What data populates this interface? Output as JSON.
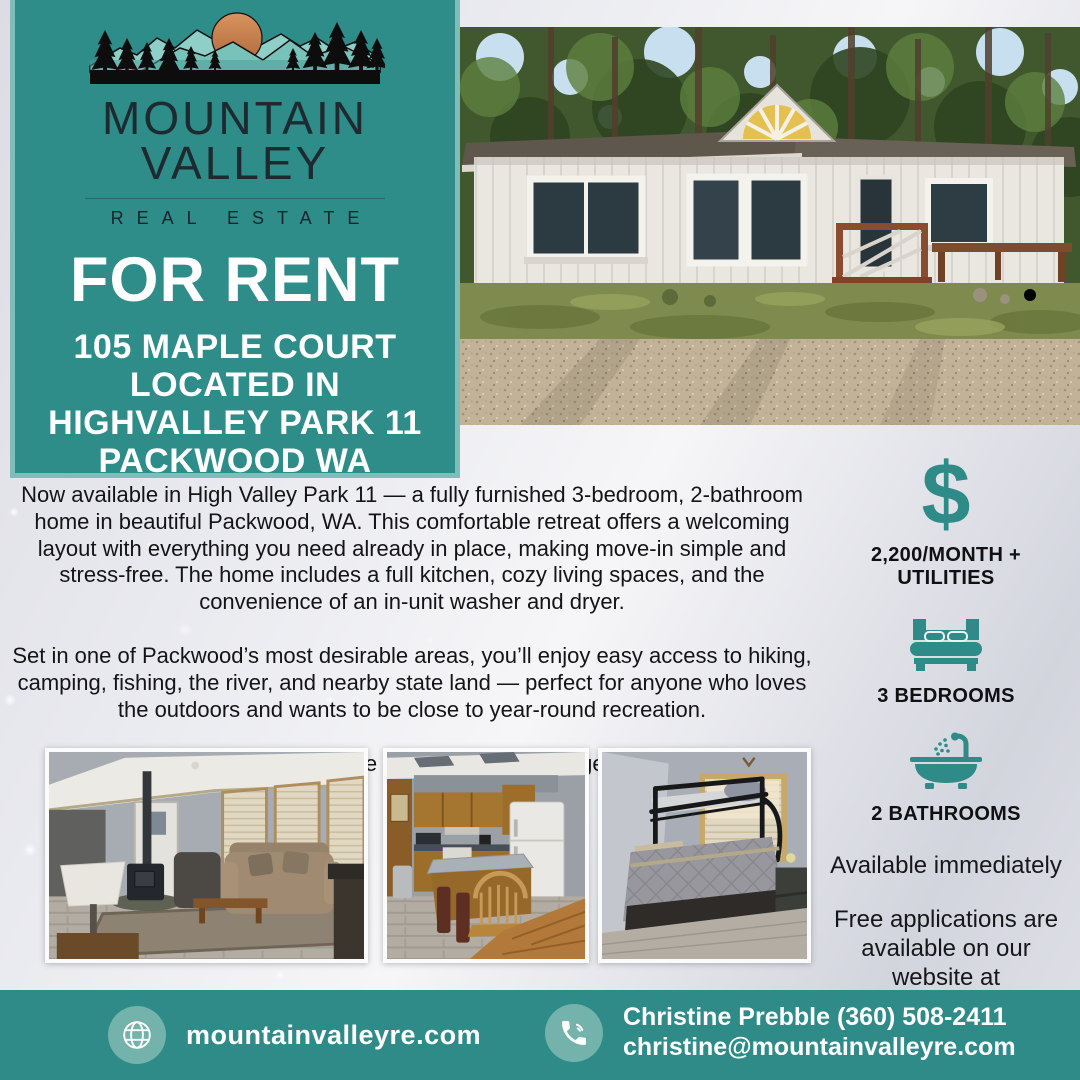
{
  "brand": {
    "name_line1": "MOUNTAIN",
    "name_line2": "VALLEY",
    "tagline": "REAL ESTATE"
  },
  "listing": {
    "banner": "FOR RENT",
    "address_lines": [
      "105 MAPLE COURT",
      "LOCATED IN",
      "HIGHVALLEY PARK 11",
      "PACKWOOD WA"
    ]
  },
  "description": {
    "paragraphs": [
      "Now available in High Valley Park 11 — a fully furnished 3-bedroom, 2-bathroom home in beautiful Packwood, WA. This comfortable retreat offers a welcoming layout with everything you need already in place, making move-in simple and stress-free. The home includes a full kitchen, cozy living spaces, and the convenience of an in-unit washer and dryer.",
      "Set in one of Packwood’s most desirable areas, you’ll enjoy easy access to hiking, camping, fishing, the river, and nearby state land — perfect for anyone who loves the outdoors and wants to be close to year-round recreation.",
      "Tenants are responsible for power and garbage pickup."
    ]
  },
  "details": {
    "price": {
      "symbol": "$",
      "label": "2,200/MONTH + UTILITIES"
    },
    "bedrooms": {
      "label": "3 BEDROOMS"
    },
    "bathrooms": {
      "label": "2 BATHROOMS"
    },
    "availability": "Available immediately",
    "applications": "Free applications are available on our website at mountainvalleyre.com"
  },
  "footer": {
    "website": {
      "text": "mountainvalleyre.com"
    },
    "contact": {
      "name_phone": "Christine Prebble (360) 508-2411",
      "email": "christine@mountainvalleyre.com"
    }
  },
  "icons": {
    "price": "dollar-sign",
    "bedrooms": "double-bed",
    "bathrooms": "bathtub-with-shower",
    "website": "globe",
    "contact": "phone-call",
    "logo": "mountains-sun-trees"
  },
  "photos": {
    "hero": "exterior-front-of-home",
    "gallery": [
      "living-room",
      "kitchen",
      "bedroom-with-bunk-beds"
    ]
  },
  "colors": {
    "teal": "#2e8c89",
    "teal_border": "#7fbdb8",
    "teal_light_circle": "#74b2ac",
    "logo_text": "#1d2b31",
    "sun_copper": "#c5784a",
    "text_dark": "#141416",
    "white": "#ffffff"
  }
}
